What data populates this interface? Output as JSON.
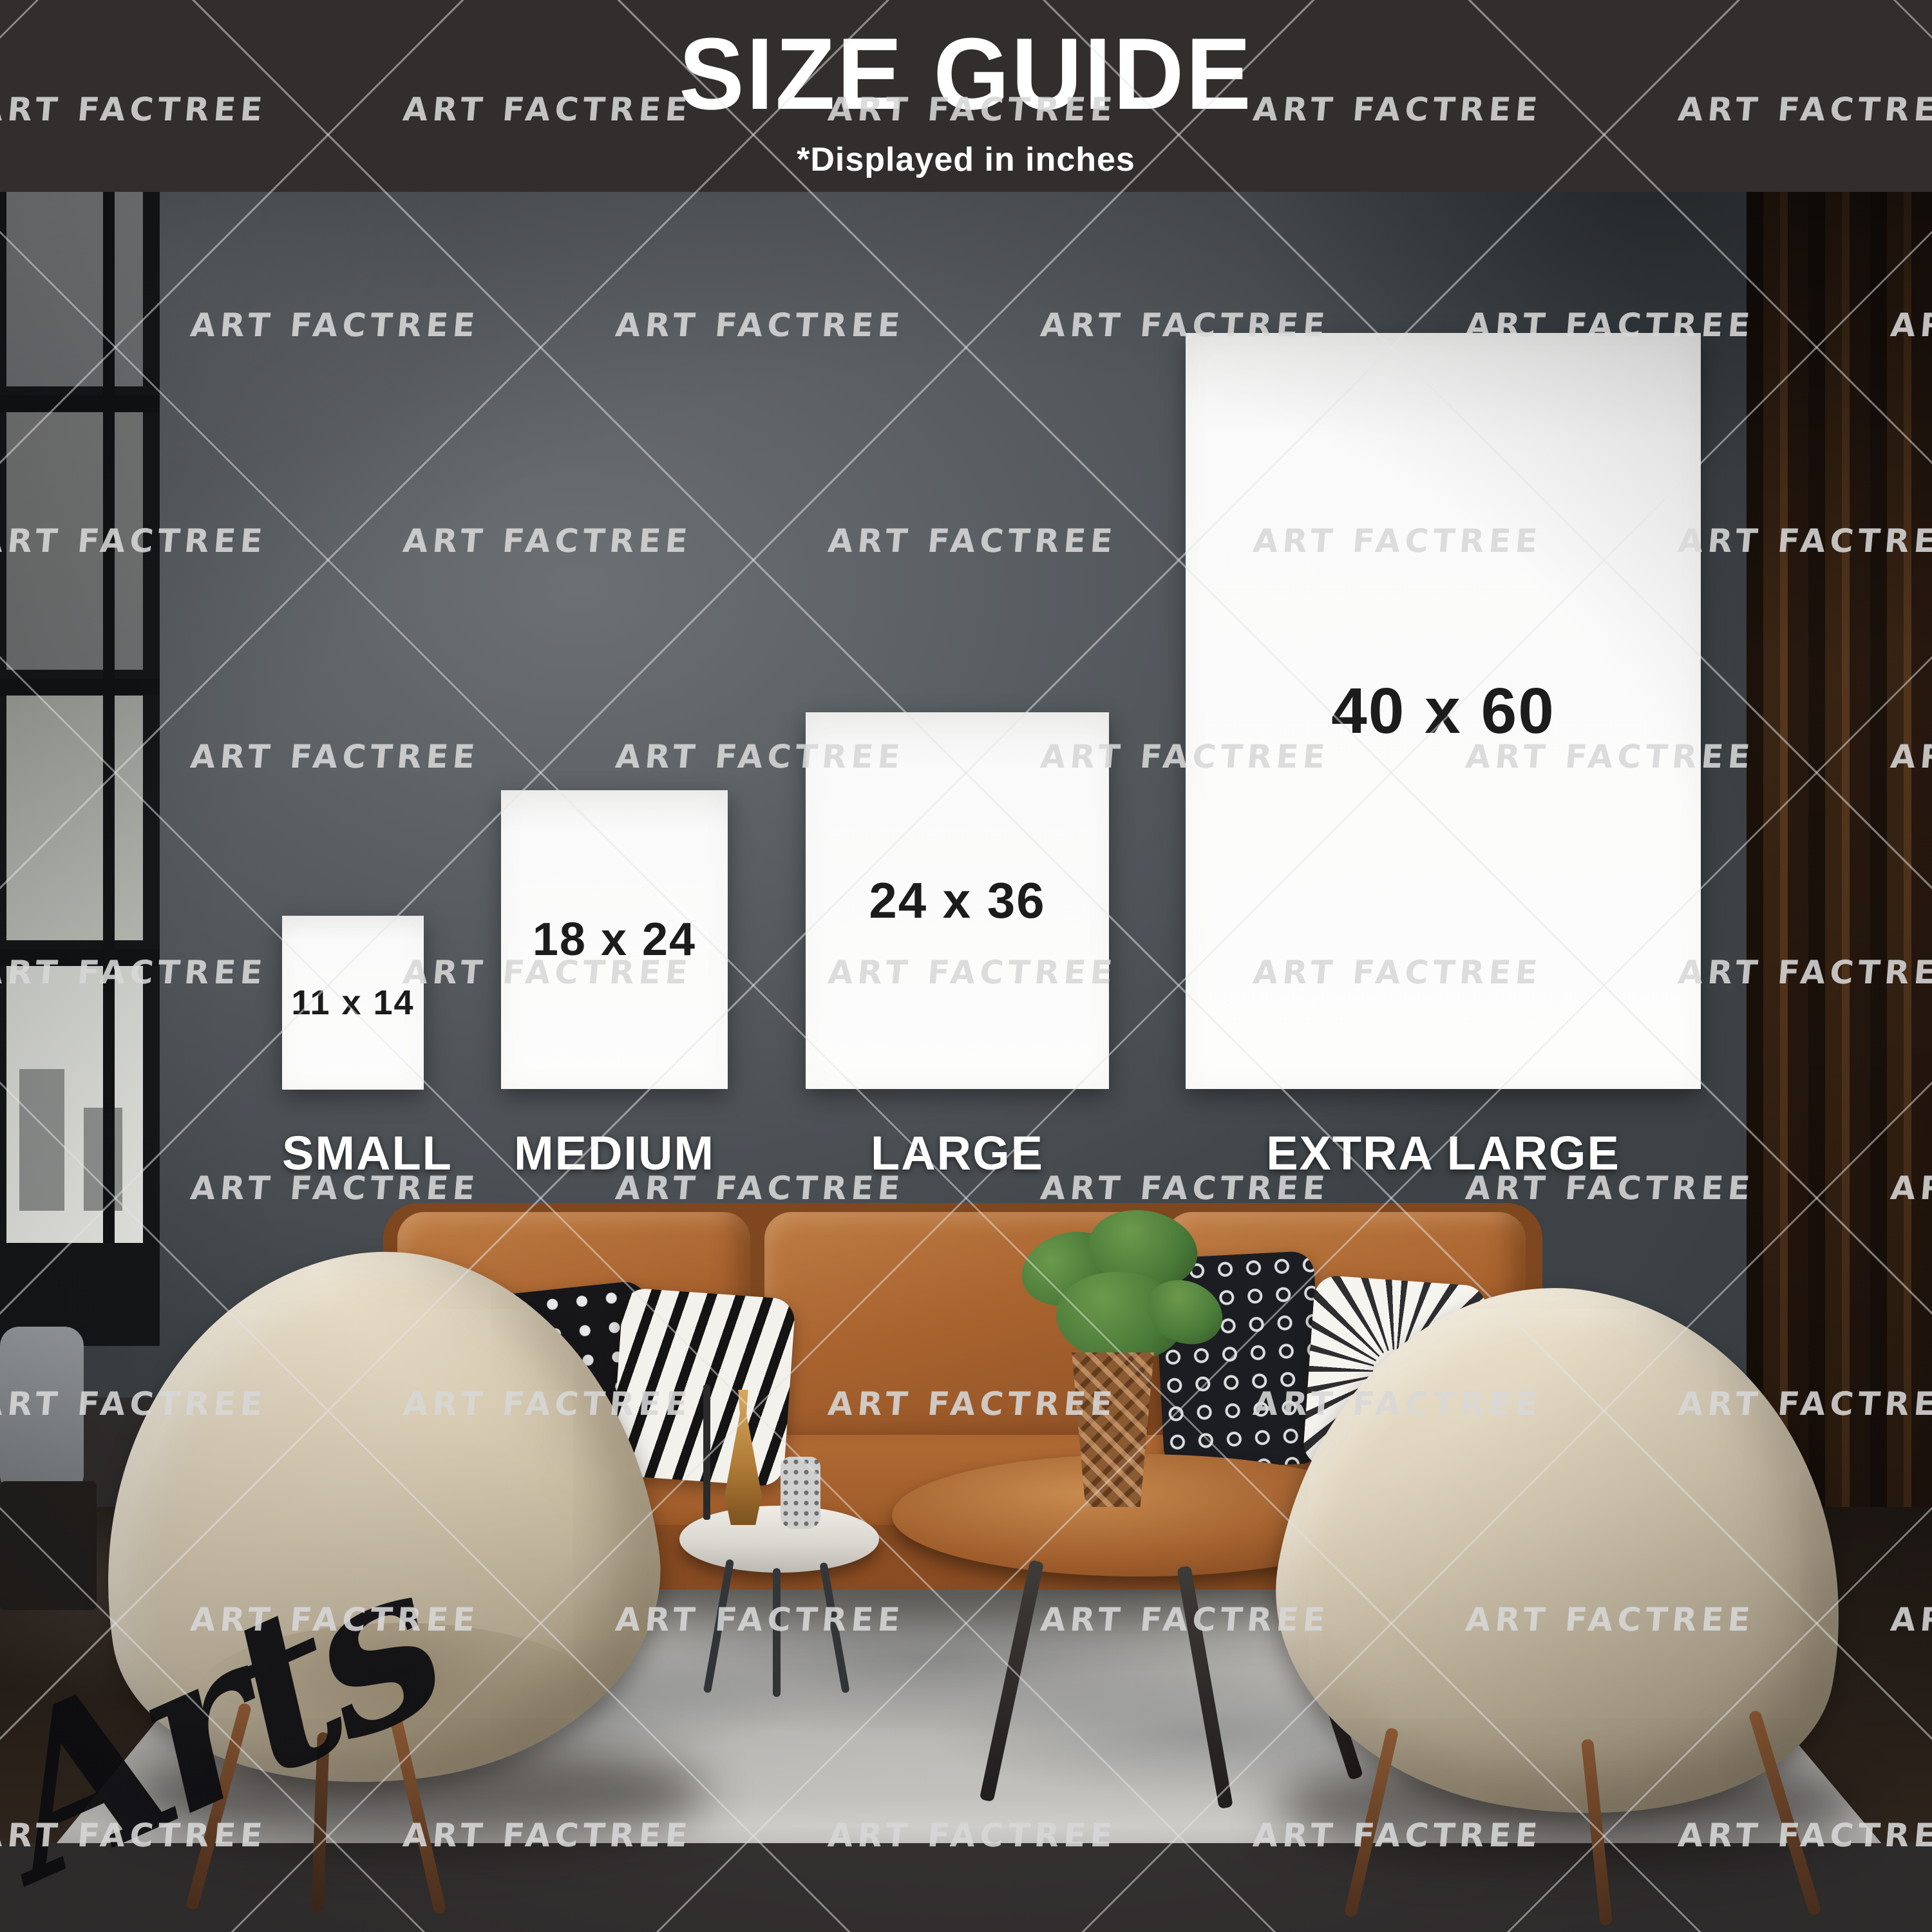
{
  "header": {
    "title": "SIZE GUIDE",
    "subtitle": "*Displayed in inches"
  },
  "size_guide": {
    "units": "inches",
    "options": [
      {
        "label": "SMALL",
        "dimensions": "11 x 14"
      },
      {
        "label": "MEDIUM",
        "dimensions": "18 x 24"
      },
      {
        "label": "LARGE",
        "dimensions": "24 x 36"
      },
      {
        "label": "EXTRA LARGE",
        "dimensions": "40 x 60"
      }
    ]
  },
  "watermark": {
    "text": "ART FACTREE"
  },
  "signature": {
    "text": "Arts"
  },
  "colors": {
    "top_bar": "#322e2e",
    "title_text": "#ffffff",
    "wall": "#575c61",
    "poster": "#fafafa",
    "size_text": "#1c1c1c",
    "label_text": "#ffffff",
    "watermark": "#d8d8d8",
    "sofa": "#a9632f",
    "chair": "#d8ccb4",
    "rug": "#c7c5c0",
    "floor": "#261c14",
    "curtain": "#2a1a10",
    "plant": "#4a7a38",
    "signature": "#0e0e12"
  }
}
